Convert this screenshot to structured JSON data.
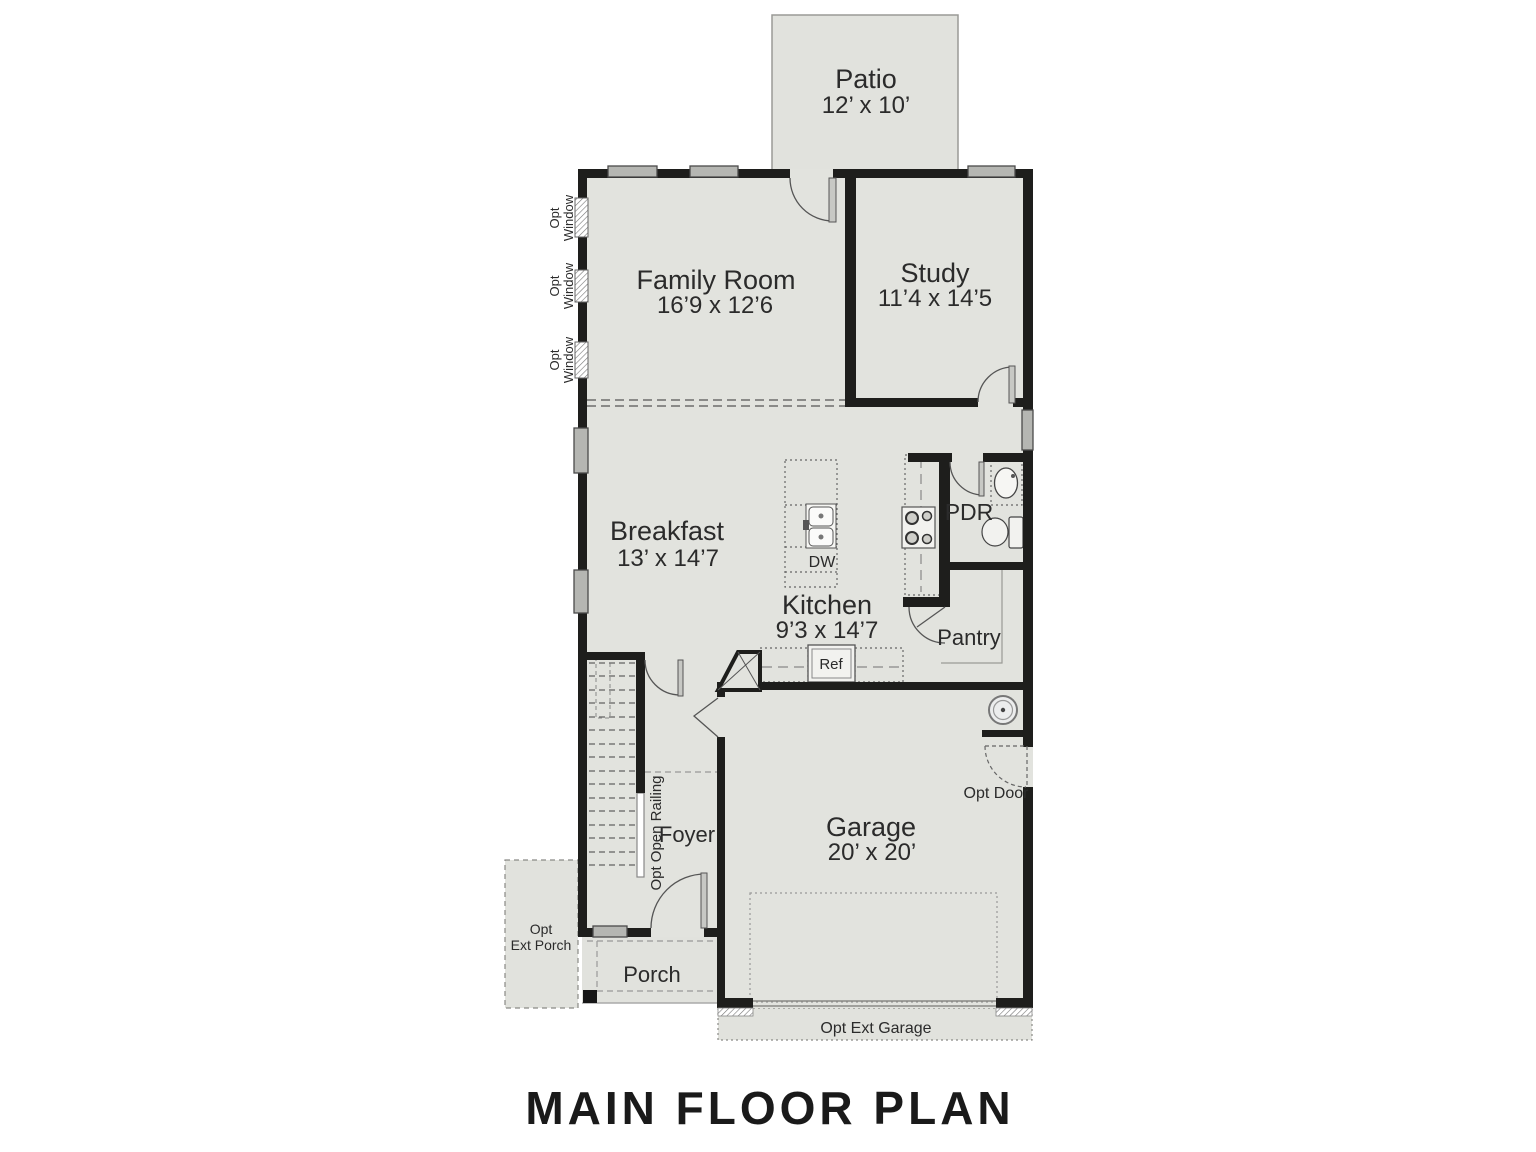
{
  "title": "MAIN FLOOR PLAN",
  "rooms": {
    "patio": {
      "name": "Patio",
      "dims": "12’ x 10’"
    },
    "family_room": {
      "name": "Family Room",
      "dims": "16’9 x 12’6"
    },
    "study": {
      "name": "Study",
      "dims": "11’4 x 14’5"
    },
    "breakfast": {
      "name": "Breakfast",
      "dims": "13’ x 14’7"
    },
    "kitchen": {
      "name": "Kitchen",
      "dims": "9’3 x 14’7"
    },
    "garage": {
      "name": "Garage",
      "dims": "20’ x 20’"
    },
    "pdr": {
      "name": "PDR"
    },
    "pantry": {
      "name": "Pantry"
    },
    "foyer": {
      "name": "Foyer"
    },
    "porch": {
      "name": "Porch"
    }
  },
  "fixtures": {
    "ref": "Ref",
    "dw": "DW"
  },
  "options": {
    "opt_window": {
      "line1": "Opt",
      "line2": "Window"
    },
    "opt_door": "Opt Door",
    "opt_ext_porch": {
      "line1": "Opt",
      "line2": "Ext Porch"
    },
    "opt_ext_garage": "Opt Ext Garage",
    "opt_open_railing": "Opt Open Railing"
  },
  "colors": {
    "floor": "#e2e3de",
    "wall": "#1e1e1c",
    "window": "#b5b6b2",
    "line": "#555555"
  }
}
